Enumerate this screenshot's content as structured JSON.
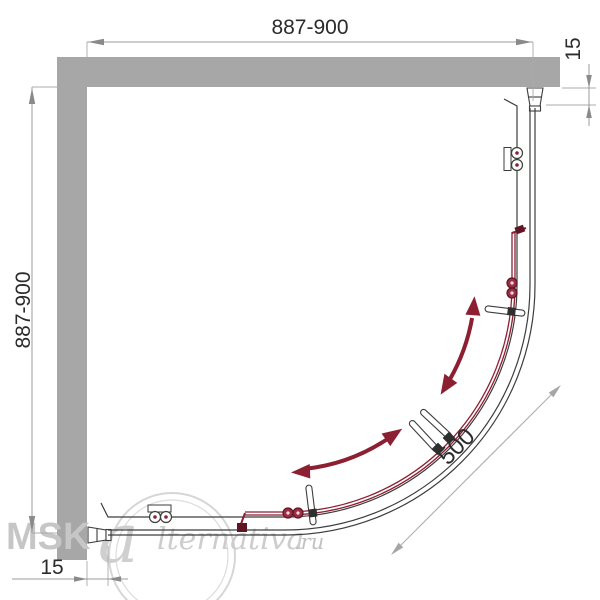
{
  "dimensions": {
    "top_width": "887-900",
    "left_height": "887-900",
    "right_offset": "15",
    "bottom_offset": "15",
    "radius": "500"
  },
  "watermark": {
    "brand_prefix": "MSK-",
    "brand_initial": "a",
    "brand_script": "lternativa",
    "brand_suffix": ".ru"
  },
  "colors": {
    "wall": "#a7a7a7",
    "outline": "#3d3d3d",
    "accent_red": "#8d1f33",
    "dark_red": "#5f1522",
    "dimension_line": "#9b9b9b",
    "watermark": "#cccccc",
    "background": "#ffffff"
  }
}
